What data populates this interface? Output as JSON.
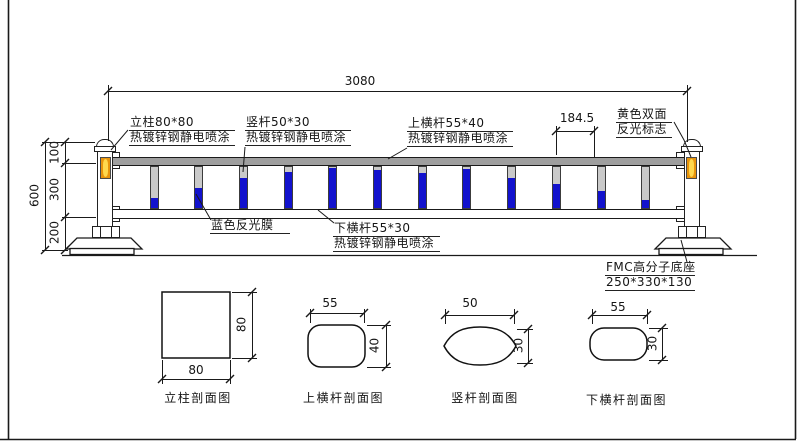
{
  "dims": {
    "total_width": "3080",
    "seg_100": "100",
    "seg_300": "300",
    "seg_200": "200",
    "overall_height": "600",
    "bar_spacing": "184.5"
  },
  "annotations": {
    "post": {
      "line1": "立柱80*80",
      "line2": "热镀锌钢静电喷涂"
    },
    "vertical_bar": {
      "line1": "竖杆50*30",
      "line2": "热镀锌钢静电喷涂"
    },
    "top_rail": {
      "line1": "上横杆55*40",
      "line2": "热镀锌钢静电喷涂"
    },
    "reflector_sign": {
      "line1": "黄色双面",
      "line2": "反光标志"
    },
    "blue_film": {
      "line1": "蓝色反光膜"
    },
    "bottom_rail": {
      "line1": "下横杆55*30",
      "line2": "热镀锌钢静电喷涂"
    },
    "base": {
      "line1": "FMC高分子底座",
      "line2": "250*330*130"
    }
  },
  "sections": {
    "post": {
      "label": "立柱剖面图",
      "width": "80",
      "height": "80"
    },
    "top_rail": {
      "label": "上横杆剖面图",
      "width": "55",
      "height": "40"
    },
    "vertical_bar": {
      "label": "竖杆剖面图",
      "width": "50",
      "height": "30"
    },
    "bottom_rail": {
      "label": "下横杆剖面图",
      "width": "55",
      "height": "30"
    }
  },
  "fence": {
    "bar_count": 12,
    "bar_start_x": 154,
    "bar_step_x": 44.7,
    "blue_fill_ratios": [
      0.25,
      0.48,
      0.72,
      0.88,
      0.97,
      0.93,
      0.86,
      0.95,
      0.72,
      0.58,
      0.42,
      0.2
    ]
  },
  "colors": {
    "line": "#1a1a1a",
    "blue_film": "#1212cd",
    "reflector_orange": "#e8940c",
    "reflector_yellow": "#ffd84d",
    "rail_gray": "#9e9e9e",
    "bar_gray": "#c9c9c9"
  }
}
